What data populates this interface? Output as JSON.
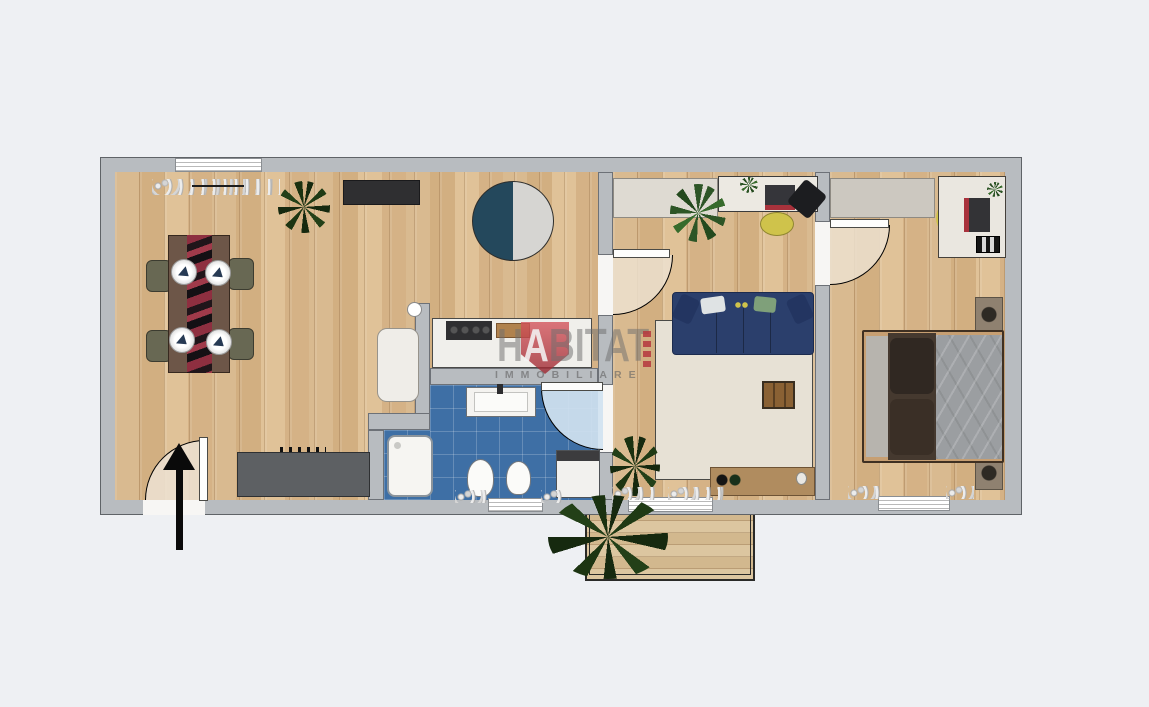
{
  "watermark": {
    "title_part1": "H",
    "title_part2": "A",
    "title_part3": "BITAT",
    "subtitle": "IMMOBILIARE",
    "brand_red": "#b5373e",
    "text_gray": "#787878"
  },
  "palette": {
    "background": "#eef0f3",
    "wall_fill": "#b8bcc0",
    "wall_outline": "#5f6367",
    "wood_floor": "#d9b98f",
    "bathroom_tile": "#3e6fa5",
    "sofa_navy": "#2b3f6c",
    "rug_beige": "#e6e0d4",
    "accent_yellow": "#cfc34b",
    "brand_red": "#b5373e",
    "door_swing": "#ece0cf"
  },
  "plan": {
    "type": "apartment-floor-plan-top-view",
    "entrance_marker": "black-arrow-pointing-up",
    "rooms": [
      {
        "name": "living-dining-kitchen",
        "floor": "wood",
        "items": [
          "window",
          "curtains",
          "plant",
          "tv-panel",
          "round-rug",
          "dining-table",
          "four-chairs",
          "four-plates",
          "kitchen-counter",
          "kitchen-island-cooktop",
          "armchair",
          "entrance-door"
        ]
      },
      {
        "name": "bathroom",
        "floor": "blue-tile",
        "items": [
          "sink-counter",
          "shower",
          "toilet",
          "bidet",
          "washing-machine",
          "window",
          "door"
        ]
      },
      {
        "name": "living-room",
        "floor": "wood",
        "items": [
          "cabinet",
          "desk",
          "laptop",
          "office-chair",
          "yellow-pouf",
          "plants",
          "corner-sofa",
          "area-rug",
          "coffee-table",
          "sideboard",
          "balcony-door",
          "door"
        ]
      },
      {
        "name": "bedroom",
        "floor": "wood",
        "items": [
          "wardrobe",
          "desk",
          "laptop",
          "keyboard",
          "yellow-chair",
          "double-bed",
          "nightstand",
          "nightstand",
          "window",
          "door"
        ]
      },
      {
        "name": "balcony",
        "floor": "wood-deck",
        "items": [
          "railing",
          "large-plant"
        ]
      }
    ]
  }
}
